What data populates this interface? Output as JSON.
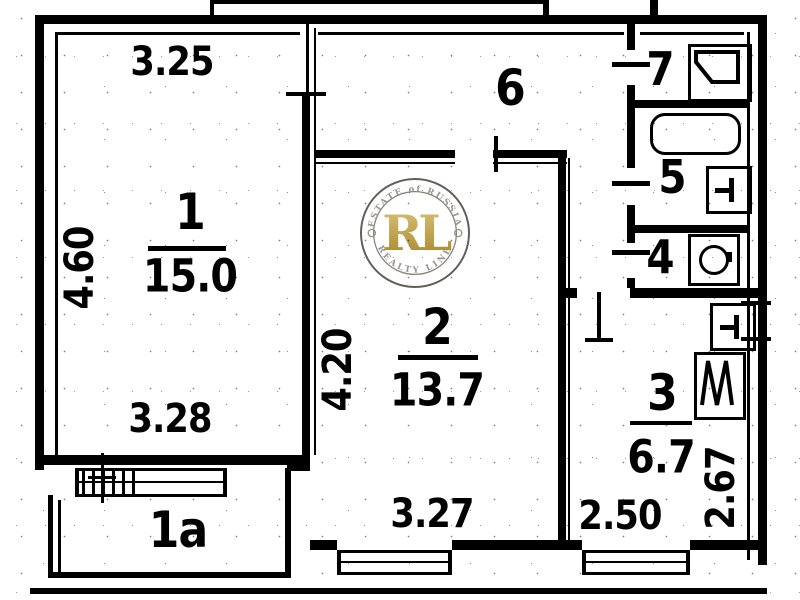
{
  "document": {
    "type": "scanned apartment floor plan",
    "background_color": "#ffffff",
    "ink_color": "#000000"
  },
  "rooms": [
    {
      "name": "room-1",
      "number": "1",
      "area": "15.0"
    },
    {
      "name": "room-1a",
      "number": "1a"
    },
    {
      "name": "room-2",
      "number": "2",
      "area": "13.7"
    },
    {
      "name": "room-3",
      "number": "3",
      "area": "6.7"
    },
    {
      "name": "room-4",
      "number": "4"
    },
    {
      "name": "room-5",
      "number": "5"
    },
    {
      "name": "room-6",
      "number": "6"
    },
    {
      "name": "room-7",
      "number": "7"
    }
  ],
  "dimensions": {
    "room1_top": "3.25",
    "room1_left": "4.60",
    "room1_bottom": "3.28",
    "room2_left": "4.20",
    "room2_bottom": "3.27",
    "room3_bottom": "2.50",
    "room3_right": "2.67"
  },
  "watermark": {
    "monogram": "RL",
    "arc_top": "ESTATE of RUSSIA",
    "arc_bottom": "REALTY LINE",
    "gold_color": "#b8922e",
    "ring_color": "#55524c"
  },
  "icons": {
    "bathtub": "rounded-rectangle",
    "sink": "square-with-tap",
    "stove": "square-with-zigzag",
    "washing_machine": "square-with-drum",
    "pantry_fixture": "square-with-diagonal-basin"
  }
}
